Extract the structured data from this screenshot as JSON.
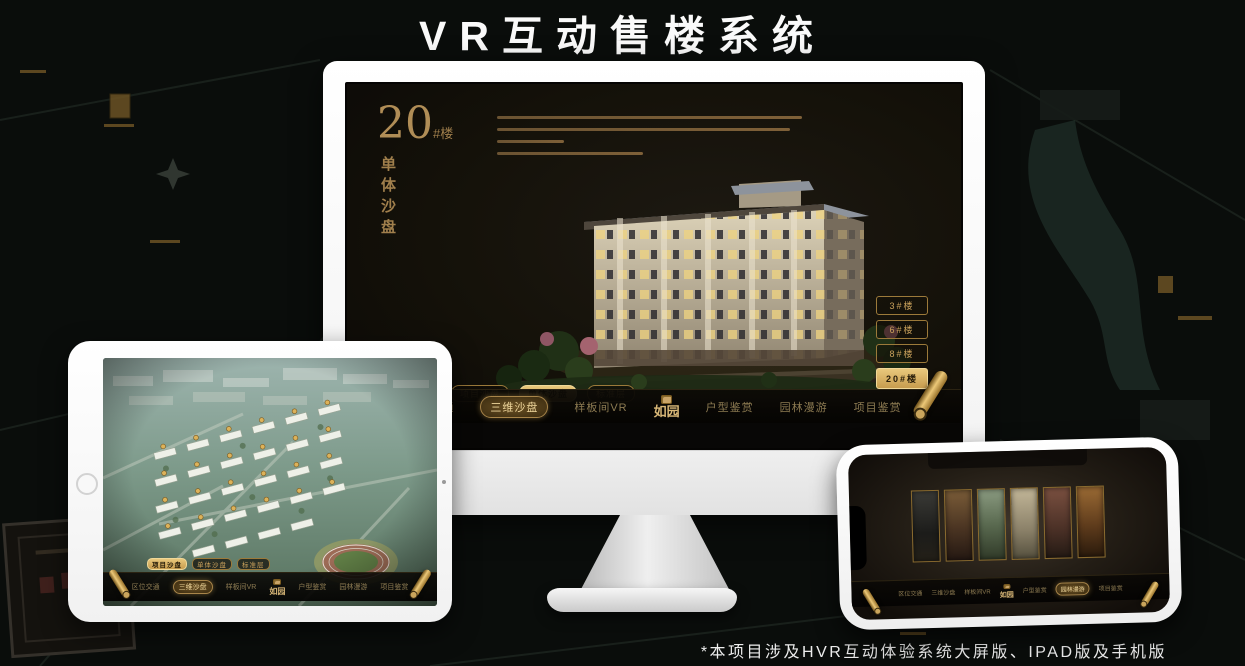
{
  "page": {
    "title": "VR互动售楼系统",
    "footnote": "*本项目涉及HVR互动体验系统大屏版、IPAD版及手机版"
  },
  "colors": {
    "gold": "#c9a468",
    "gold_bright": "#e9c87c",
    "gold_dark": "#8a6b2f",
    "screen_bg": "#141109",
    "title_text": "#fafafa"
  },
  "monitor": {
    "app": {
      "heading": {
        "number": "20",
        "suffix": "#楼",
        "vertical": "单体沙盘"
      },
      "building_buttons": [
        {
          "label": "3#楼",
          "active": false
        },
        {
          "label": "6#楼",
          "active": false
        },
        {
          "label": "8#楼",
          "active": false
        },
        {
          "label": "20#楼",
          "active": true
        }
      ],
      "sub_tabs": [
        {
          "label": "项目沙盘",
          "active": false
        },
        {
          "label": "单体沙盘",
          "active": true
        },
        {
          "label": "标准层",
          "active": false
        }
      ],
      "nav": {
        "logo": "如园",
        "items": [
          {
            "label": "区位交通",
            "active": false
          },
          {
            "label": "三维沙盘",
            "active": true
          },
          {
            "label": "样板间VR",
            "active": false
          },
          {
            "label": "户型鉴赏",
            "active": false
          },
          {
            "label": "园林漫游",
            "active": false
          },
          {
            "label": "项目鉴赏",
            "active": false
          }
        ]
      }
    }
  },
  "tablet": {
    "app": {
      "sub_tabs": [
        {
          "label": "项目沙盘",
          "active": true
        },
        {
          "label": "单体沙盘",
          "active": false
        },
        {
          "label": "标准层",
          "active": false
        }
      ],
      "nav": {
        "logo": "如园",
        "items": [
          {
            "label": "区位交通",
            "active": false
          },
          {
            "label": "三维沙盘",
            "active": true
          },
          {
            "label": "样板间VR",
            "active": false
          },
          {
            "label": "户型鉴赏",
            "active": false
          },
          {
            "label": "园林漫游",
            "active": false
          },
          {
            "label": "项目鉴赏",
            "active": false
          }
        ]
      }
    }
  },
  "phone": {
    "app": {
      "nav": {
        "logo": "如园",
        "items": [
          {
            "label": "区位交通",
            "active": false
          },
          {
            "label": "三维沙盘",
            "active": false
          },
          {
            "label": "样板间VR",
            "active": false
          },
          {
            "label": "户型鉴赏",
            "active": false
          },
          {
            "label": "园林漫游",
            "active": true
          },
          {
            "label": "项目鉴赏",
            "active": false
          }
        ]
      }
    }
  }
}
